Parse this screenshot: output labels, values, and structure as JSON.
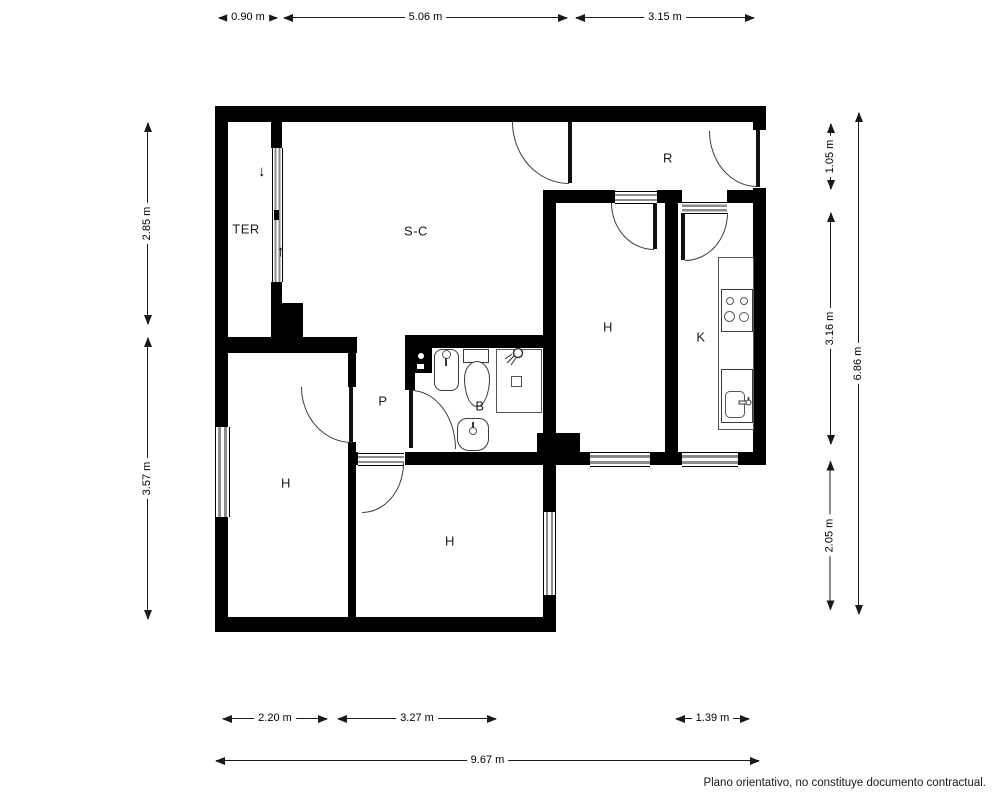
{
  "rooms": {
    "terrace": {
      "label": "TER"
    },
    "living": {
      "label": "S-C"
    },
    "hall": {
      "label": "R"
    },
    "bedroom_right": {
      "label": "H"
    },
    "kitchen": {
      "label": "K"
    },
    "corridor": {
      "label": "P"
    },
    "bathroom": {
      "label": "B"
    },
    "bedroom_left": {
      "label": "H"
    },
    "bedroom_bottom": {
      "label": "H"
    }
  },
  "dimensions": {
    "top": [
      {
        "label": "0.90 m"
      },
      {
        "label": "5.06 m"
      },
      {
        "label": "3.15 m"
      }
    ],
    "bottom": [
      {
        "label": "2.20 m"
      },
      {
        "label": "3.27 m"
      },
      {
        "label": "1.39 m"
      }
    ],
    "bottom_total": {
      "label": "9.67 m"
    },
    "left": [
      {
        "label": "2.85 m"
      },
      {
        "label": "3.57 m"
      }
    ],
    "right": [
      {
        "label": "1.05 m"
      },
      {
        "label": "3.16 m"
      },
      {
        "label": "2.05 m"
      }
    ],
    "right_total": {
      "label": "6.86 m"
    }
  },
  "terrace_arrows": {
    "down": "↓",
    "up": "↑"
  },
  "disclaimer": "Plano orientativo, no constituye documento contractual.",
  "colors": {
    "wall": "#000000",
    "dimension_line": "#1a1a1a",
    "window_glazing": "#8c8c8c",
    "background": "#ffffff"
  }
}
